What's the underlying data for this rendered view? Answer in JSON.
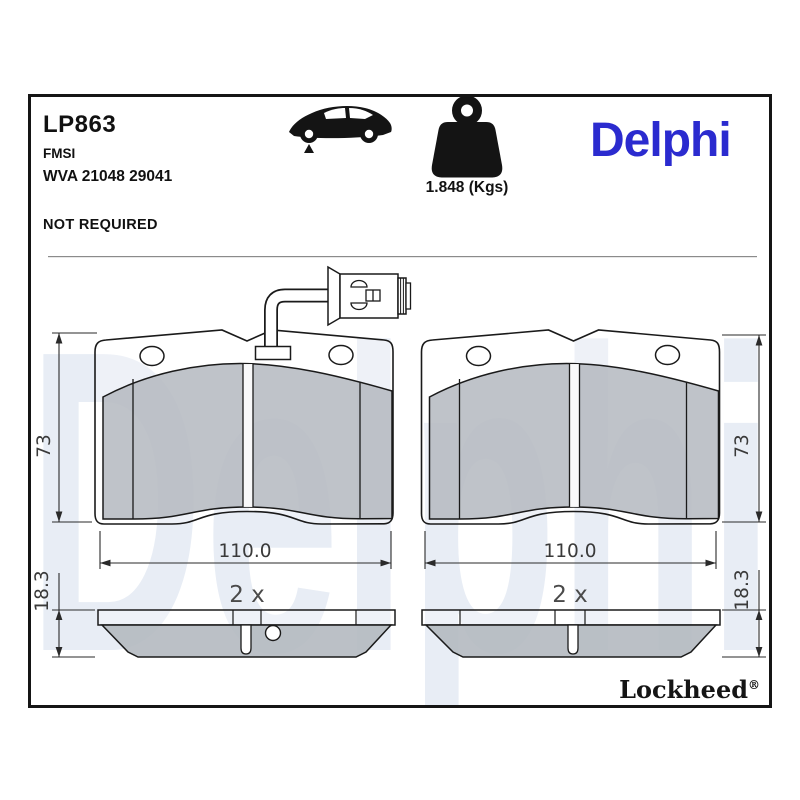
{
  "header": {
    "part_number": "LP863",
    "standard_label": "FMSI",
    "wva_code": "WVA 21048 29041",
    "shim_note": "NOT REQUIRED",
    "weight": "1.848 (Kgs)",
    "brand_logo": "Delphi"
  },
  "icons": {
    "vehicle": "car-side-icon",
    "mass": "weight-kettlebell-icon"
  },
  "watermark": "Delphi",
  "drawing": {
    "pads": [
      {
        "id": "left",
        "height": "73",
        "width": "110.0",
        "quantity": "2 x",
        "thickness": "18.3",
        "wear_sensor": true
      },
      {
        "id": "right",
        "height": "73",
        "width": "110.0",
        "quantity": "2 x",
        "thickness": "18.3",
        "wear_sensor": false
      }
    ]
  },
  "footer": {
    "brand": "Lockheed",
    "registered_mark": "®"
  },
  "colors": {
    "brand_blue": "#2B2BCF",
    "watermark_blue": "#E8EDF5",
    "friction_gray": "#B4B9C0",
    "line_black": "#1A1A1A"
  }
}
